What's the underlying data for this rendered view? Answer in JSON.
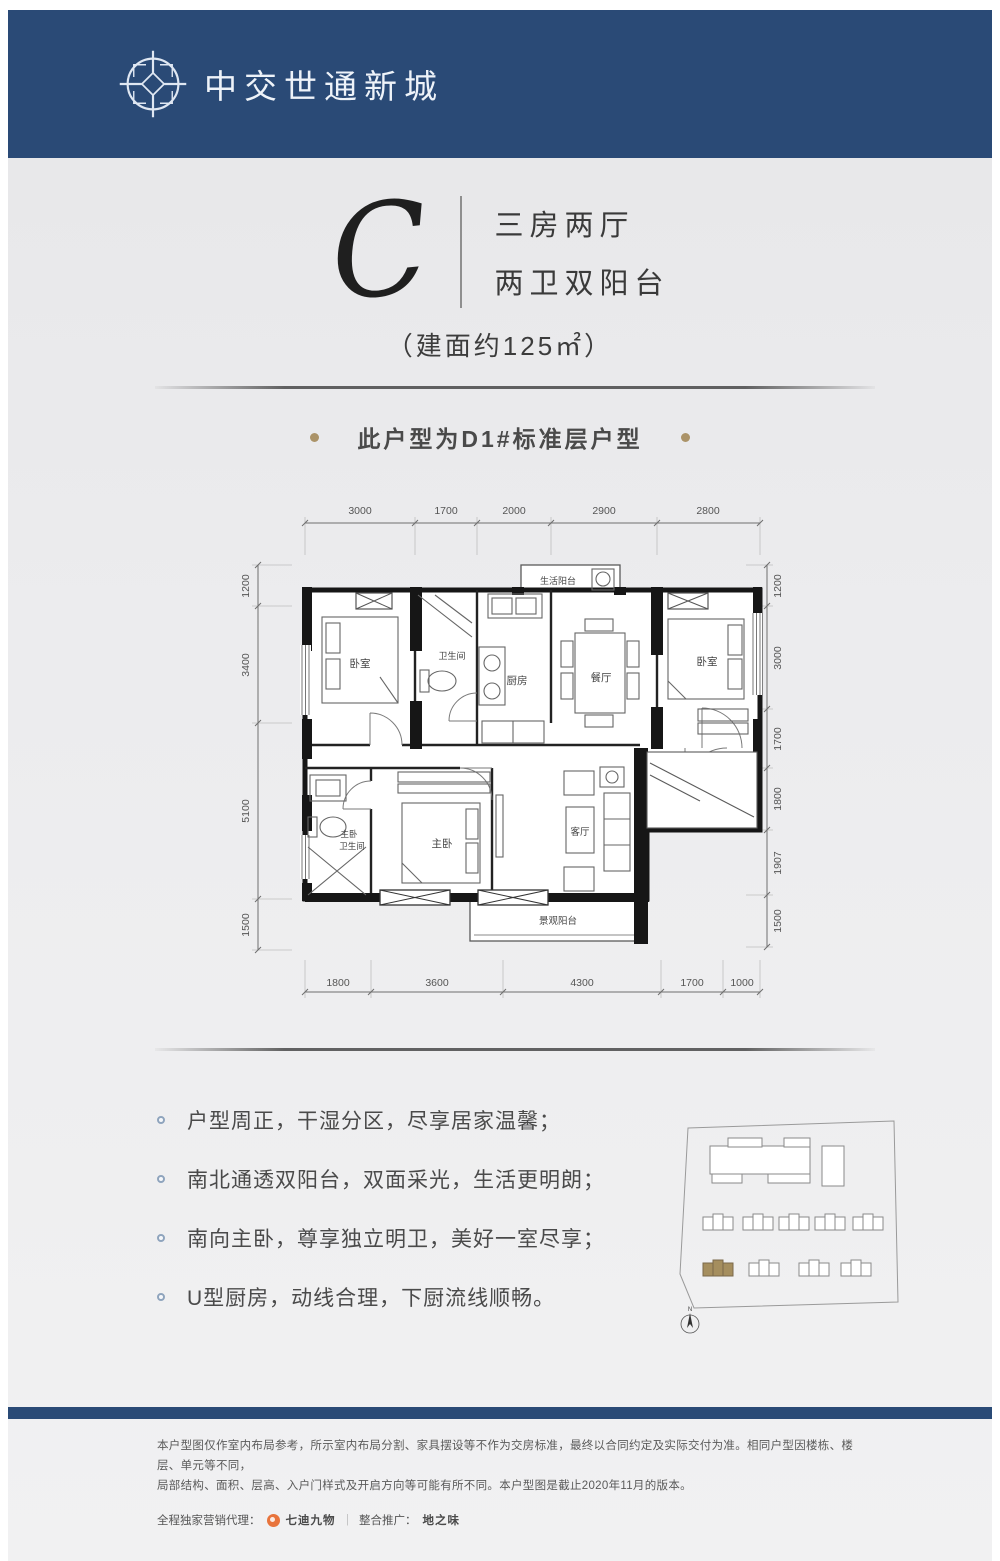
{
  "header": {
    "brand": "中交世通新城"
  },
  "unit": {
    "letter": "C",
    "type_line1": "三房两厅",
    "type_line2": "两卫双阳台",
    "area": "（建面约125㎡）",
    "note": "此户型为D1#标准层户型"
  },
  "floorplan": {
    "dims": {
      "top": [
        "3000",
        "1700",
        "2000",
        "2900",
        "2800"
      ],
      "bottom": [
        "1800",
        "3600",
        "4300",
        "1700",
        "1000"
      ],
      "left": [
        "1200",
        "3400",
        "5100",
        "1500"
      ],
      "right": [
        "1200",
        "3000",
        "1700",
        "1800",
        "1907",
        "1500"
      ]
    },
    "rooms": {
      "bedroom_left": "卧室",
      "bathroom": "卫生间",
      "kitchen": "厨房",
      "dining": "餐厅",
      "bedroom_right": "卧室",
      "life_balcony": "生活阳台",
      "master_bath_l1": "主卧",
      "master_bath_l2": "卫生间",
      "master_bedroom": "主卧",
      "living": "客厅",
      "view_balcony": "景观阳台"
    }
  },
  "features": [
    "户型周正，干湿分区，尽享居家温馨；",
    "南北通透双阳台，双面采光，生活更明朗；",
    "南向主卧，尊享独立明卫，美好一室尽享；",
    "U型厨房，动线合理，下厨流线顺畅。"
  ],
  "siteplan": {
    "north_label": "N"
  },
  "footer": {
    "disclaimer_line1": "本户型图仅作室内布局参考，所示室内布局分割、家具摆设等不作为交房标准，最终以合同约定及实际交付为准。相同户型因楼栋、楼层、单元等不同，",
    "disclaimer_line2": "局部结构、面积、层高、入户门样式及开启方向等可能有所不同。本户型图是截止2020年11月的版本。",
    "agency_label": "全程独家营销代理：",
    "agency_name": "七迪九物",
    "separator": "｜",
    "promo_label": "整合推广：",
    "promo_name": "地之味"
  },
  "colors": {
    "navy": "#2a4a76",
    "gold": "#ab9368",
    "orange": "#e8743c"
  }
}
